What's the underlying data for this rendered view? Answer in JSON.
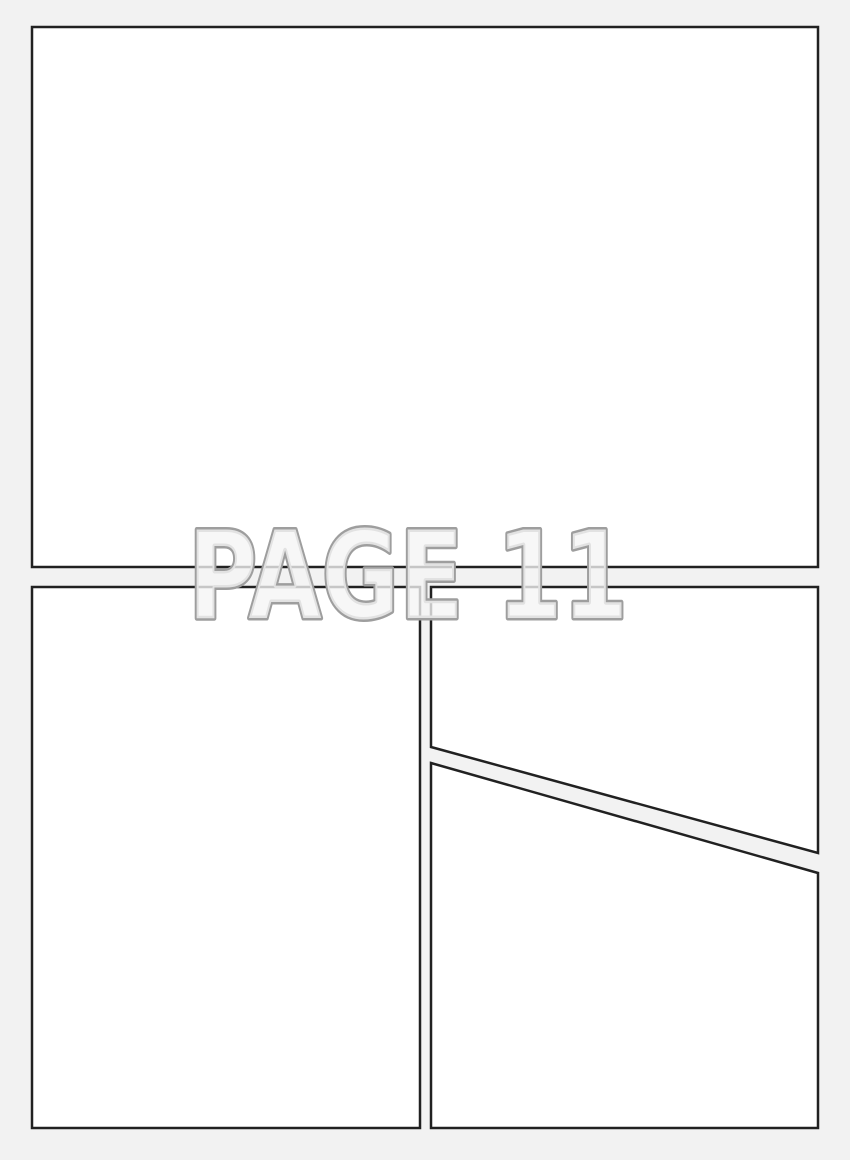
{
  "page": {
    "label": "PAGE 11",
    "panel_count": 4,
    "panels": [
      {
        "name": "top-full-width-panel"
      },
      {
        "name": "bottom-left-panel"
      },
      {
        "name": "bottom-right-upper-panel"
      },
      {
        "name": "bottom-right-lower-panel"
      }
    ]
  },
  "colors": {
    "page_background": "#f2f2f2",
    "panel_fill": "#ffffff",
    "panel_border": "#212121",
    "label_outline": "#9e9e9e",
    "label_fill": "#f5f5f5"
  }
}
